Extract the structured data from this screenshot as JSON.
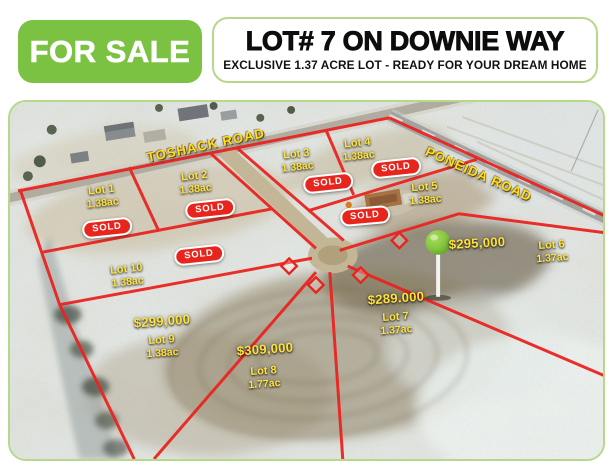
{
  "header": {
    "for_sale_label": "FOR SALE",
    "title": "LOT# 7 ON DOWNIE WAY",
    "subtitle": "EXCLUSIVE 1.37 ACRE LOT - READY FOR YOUR DREAM HOME"
  },
  "colors": {
    "brand_green": "#7cc242",
    "box_border_green": "#b5d988",
    "boundary_red": "#e8251d",
    "label_yellow": "#ffe33a",
    "road_label_yellow": "#ffdf1b",
    "pin_green": "#85c43e"
  },
  "map": {
    "roads": [
      {
        "name": "TOSHACK ROAD"
      },
      {
        "name": "PONEIDA ROAD"
      }
    ],
    "sold_badge_label": "SOLD",
    "lots": [
      {
        "name": "Lot 1",
        "acreage": "1.38ac",
        "status": "sold"
      },
      {
        "name": "Lot 2",
        "acreage": "1.38ac",
        "status": "sold"
      },
      {
        "name": "Lot 3",
        "acreage": "1.38ac",
        "status": "sold"
      },
      {
        "name": "Lot 4",
        "acreage": "1.38ac",
        "status": "sold"
      },
      {
        "name": "Lot 5",
        "acreage": "1.38ac",
        "status": "sold"
      },
      {
        "name": "Lot 6",
        "acreage": "1.37ac",
        "status": "available",
        "price": "$295,000"
      },
      {
        "name": "Lot 7",
        "acreage": "1.37ac",
        "status": "available",
        "price": "$289.000"
      },
      {
        "name": "Lot 8",
        "acreage": "1.77ac",
        "status": "available",
        "price": "$309,000"
      },
      {
        "name": "Lot 9",
        "acreage": "1.38ac",
        "status": "available",
        "price": "$299,000"
      },
      {
        "name": "Lot 10",
        "acreage": "1.38ac",
        "status": "sold"
      }
    ]
  }
}
